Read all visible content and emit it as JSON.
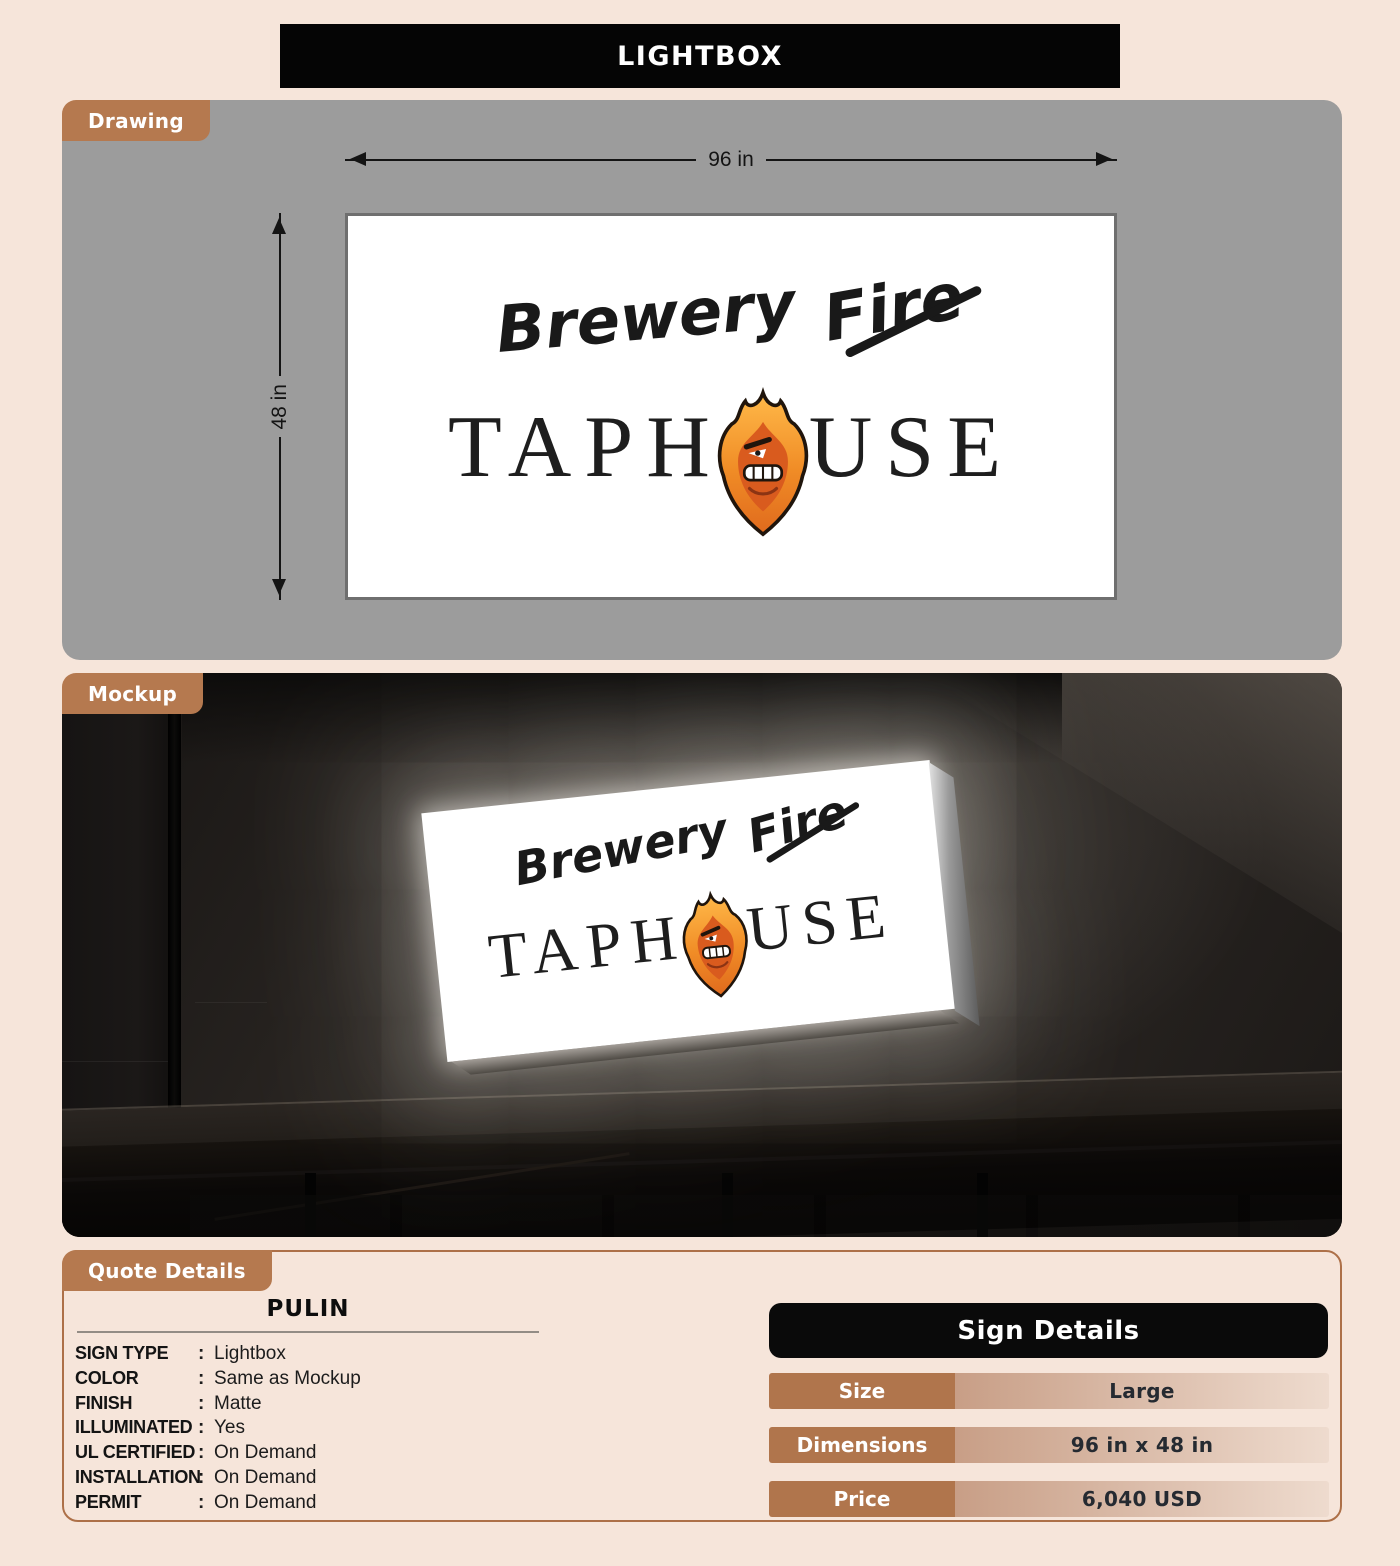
{
  "page": {
    "title": "LIGHTBOX"
  },
  "drawing": {
    "tab": "Drawing",
    "width_label": "96 in",
    "height_label": "48 in"
  },
  "mockup": {
    "tab": "Mockup"
  },
  "logo": {
    "word1": "Brewery",
    "word2": "Fire",
    "taphouse_left": "TAPH",
    "taphouse_right": "USE"
  },
  "quote": {
    "tab": "Quote Details",
    "name": "PULIN",
    "colon": ":",
    "fields": [
      {
        "label": "SIGN TYPE",
        "value": "Lightbox"
      },
      {
        "label": "COLOR",
        "value": "Same as Mockup"
      },
      {
        "label": "FINISH",
        "value": "Matte"
      },
      {
        "label": "ILLUMINATED",
        "value": "Yes"
      },
      {
        "label": "UL CERTIFIED",
        "value": "On Demand"
      },
      {
        "label": "INSTALLATION",
        "value": "On Demand"
      },
      {
        "label": "PERMIT",
        "value": "On Demand"
      }
    ]
  },
  "sign_details": {
    "title": "Sign Details",
    "rows": [
      {
        "label": "Size",
        "value": "Large"
      },
      {
        "label": "Dimensions",
        "value": "96 in x 48 in"
      },
      {
        "label": "Price",
        "value": "6,040 USD"
      }
    ]
  },
  "colors": {
    "accent_brown": "#b5794f",
    "page_background": "#f6e5da",
    "drawing_panel_gray": "#9c9c9c",
    "header_black": "#0a0a0a",
    "table_label_brown": "#b0754c",
    "flame_orange": "#f08c26"
  }
}
